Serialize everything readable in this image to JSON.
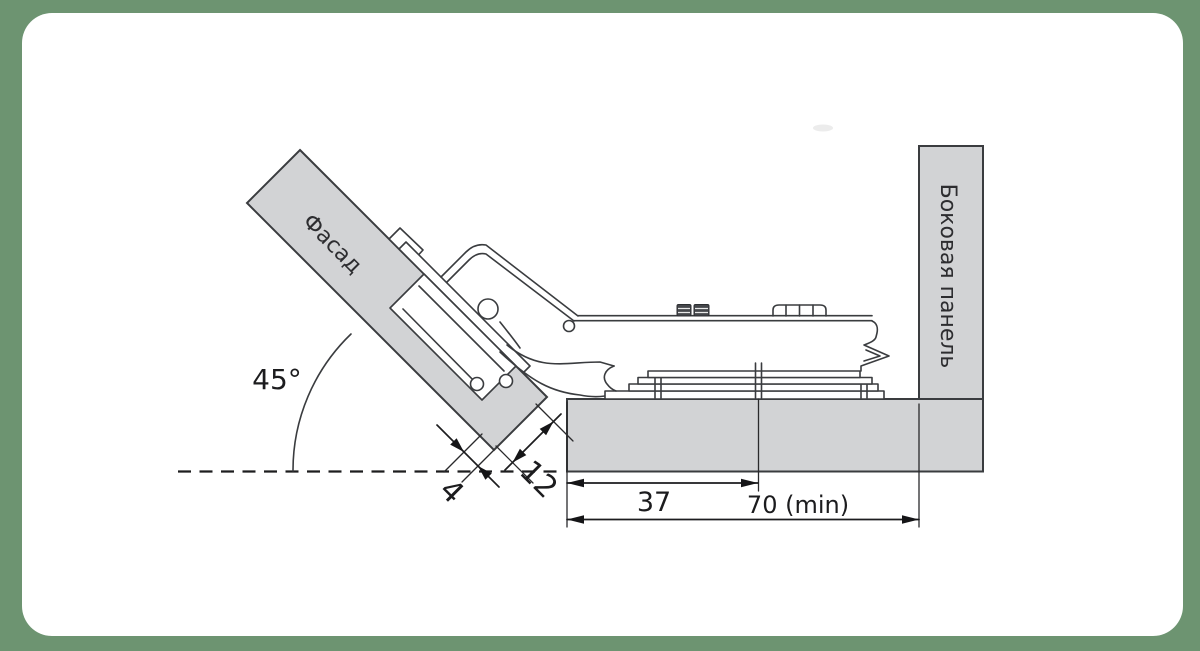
{
  "frame": {
    "background_color": "#6d9471",
    "card_color": "#ffffff"
  },
  "diagram": {
    "title": "45-degree corner hinge mounting scheme",
    "labels": {
      "facade": "Фасад",
      "side_panel": "Боковая панель"
    },
    "dimensions": {
      "angle": "45°",
      "facade_offset": "4",
      "overlay": "12",
      "plate_setback": "37",
      "min_depth": "70 (min)"
    },
    "colors": {
      "panel_fill": "#d2d3d5",
      "outline": "#3a3c3f",
      "dimension_line": "#1d1d1f"
    }
  }
}
